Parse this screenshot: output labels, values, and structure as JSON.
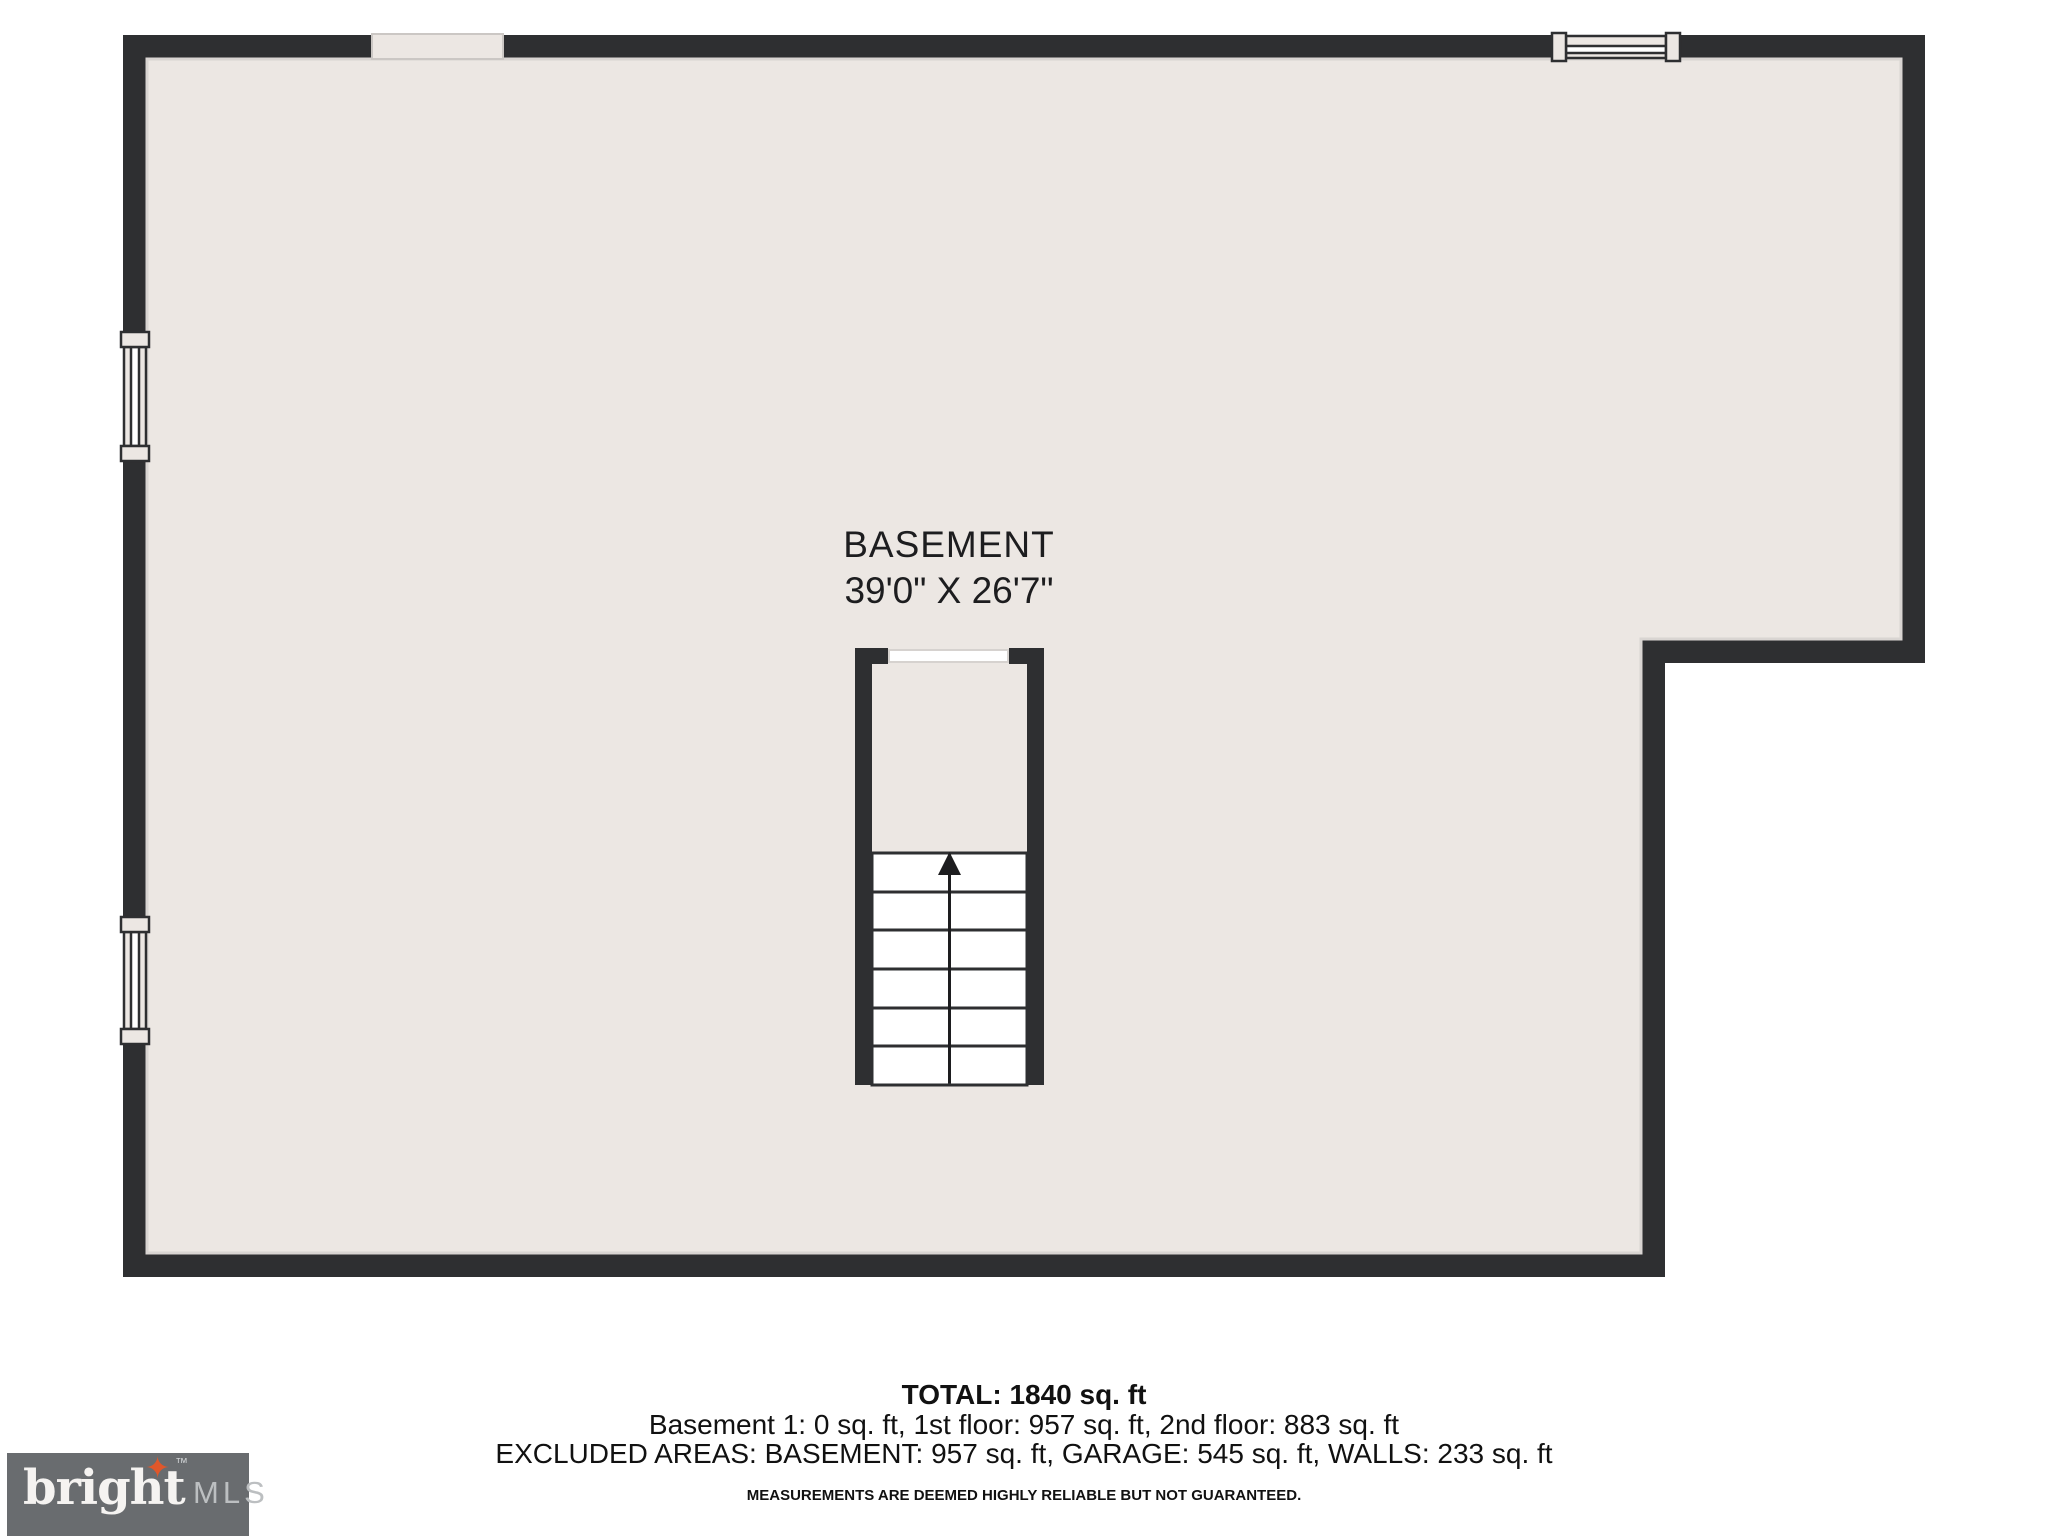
{
  "plan": {
    "room_label": "BASEMENT",
    "room_dimensions": "39'0\" X 26'7\"",
    "colors": {
      "wall": "#2e2f31",
      "floor": "#ece7e3",
      "floor_outline": "#d9d5d2",
      "stair_fill": "#ffffff"
    }
  },
  "summary": {
    "total": "TOTAL: 1840 sq. ft",
    "floor_breakdown": "Basement 1: 0 sq. ft, 1st floor: 957 sq. ft, 2nd floor: 883 sq. ft",
    "excluded_areas": "EXCLUDED AREAS: BASEMENT: 957 sq. ft, GARAGE: 545 sq. ft, WALLS: 233 sq. ft",
    "disclaimer": "MEASUREMENTS ARE DEEMED HIGHLY RELIABLE BUT NOT GUARANTEED."
  },
  "logo": {
    "brand": "bright",
    "suffix": "MLS",
    "trademark": "™",
    "star_glyph": "✦",
    "accent_color": "#e0572a",
    "background": "#696c6f"
  }
}
